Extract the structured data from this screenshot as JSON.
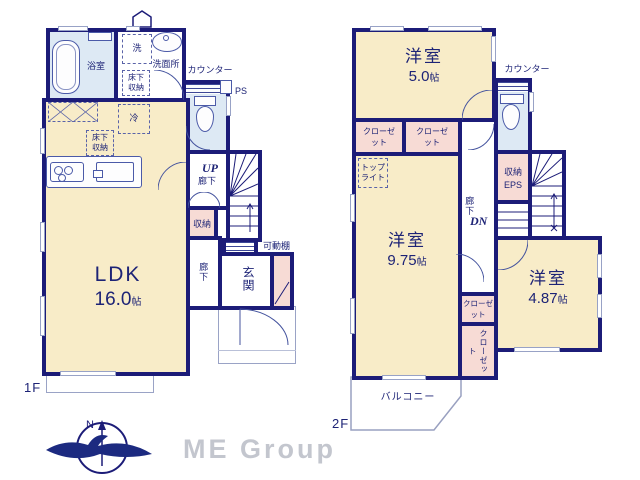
{
  "colors": {
    "wall": "#1c1c78",
    "room_fill": "#f8ecc8",
    "closet_fill": "#f7dbd5",
    "wet_area_fill": "#dde9f4",
    "text": "#1d2376",
    "logo_gray": "#c3c6ce"
  },
  "floor1": {
    "label": "1F",
    "bathroom": "浴室",
    "washer": "洗",
    "washroom": "洗面所",
    "underfloor_storage_wash": "床下収納",
    "counter_label": "カウンター",
    "ps": "PS",
    "fridge": "冷",
    "underfloor_storage_kitchen": "床下収納",
    "ldk": {
      "name": "LDK",
      "size": "16.0",
      "unit": "帖"
    },
    "up": "UP",
    "hallway_up": "廊下",
    "storage": "収納",
    "movable_shelf": "可動棚",
    "hallway": "廊下",
    "entrance": "玄関"
  },
  "floor2": {
    "label": "2F",
    "room_5": {
      "name": "洋室",
      "size": "5.0",
      "unit": "帖"
    },
    "closet_1": "クローゼット",
    "closet_2": "クローゼット",
    "counter_label": "カウンター",
    "toplight": "トップライト",
    "room_975": {
      "name": "洋室",
      "size": "9.75",
      "unit": "帖"
    },
    "hallway": "廊下",
    "dn": "DN",
    "storage": "収納",
    "eps": "EPS",
    "room_487": {
      "name": "洋室",
      "size": "4.87",
      "unit": "帖"
    },
    "closet_3": "クローゼット",
    "closet_4": "クローゼット",
    "balcony": "バルコニー"
  },
  "footer": {
    "compass_n": "N",
    "logo": "ME Group"
  }
}
